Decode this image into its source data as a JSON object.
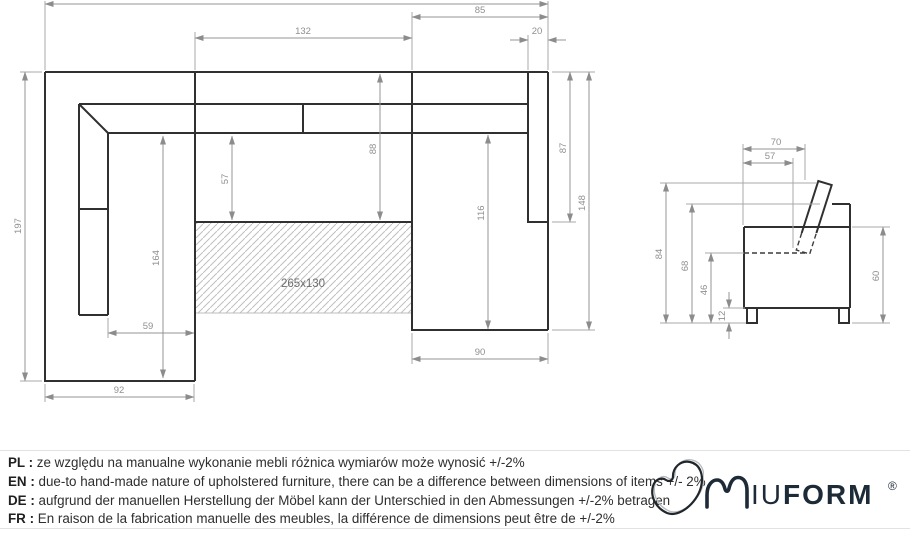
{
  "drawing": {
    "plan": {
      "area_label": "265x130",
      "dims": {
        "seat_width": "132",
        "right_top_width": "85",
        "right_arm_width": "20",
        "right_inner_depth": "87",
        "right_outer_depth": "148",
        "mid_depth_left": "57",
        "mid_depth_right": "88",
        "right_seat_depth": "116",
        "left_total_depth": "197",
        "left_inner_length": "164",
        "left_inner_width": "59",
        "left_width": "92",
        "right_width": "90"
      }
    },
    "side": {
      "dims": {
        "top_depth": "70",
        "seat_depth": "57",
        "total_height": "84",
        "back_height": "68",
        "seat_height": "46",
        "leg_height": "12",
        "arm_height": "60"
      }
    }
  },
  "notes": {
    "separator": " : ",
    "items": [
      {
        "lang": "PL",
        "text": "ze względu na manualne wykonanie mebli różnica wymiarów może wynosić +/-2%"
      },
      {
        "lang": "EN",
        "text": "due-to hand-made nature of upholstered furniture, there can be a difference between dimensions of items +/- 2%"
      },
      {
        "lang": "DE",
        "text": "aufgrund der manuellen Herstellung der Möbel kann der Unterschied in den Abmessungen +/-2% betragen"
      },
      {
        "lang": "FR",
        "text": "En raison de la fabrication manuelle des meubles, la différence de dimensions peut être de +/-2%"
      }
    ]
  },
  "brand": {
    "letters_light": "IU",
    "letters_bold": "FORM",
    "registered": "®"
  },
  "colors": {
    "outline": "#303030",
    "dimension": "#8f8f8f",
    "hatch": "#bfbfbf",
    "brand_navy": "#1d2a37",
    "background": "#ffffff"
  }
}
